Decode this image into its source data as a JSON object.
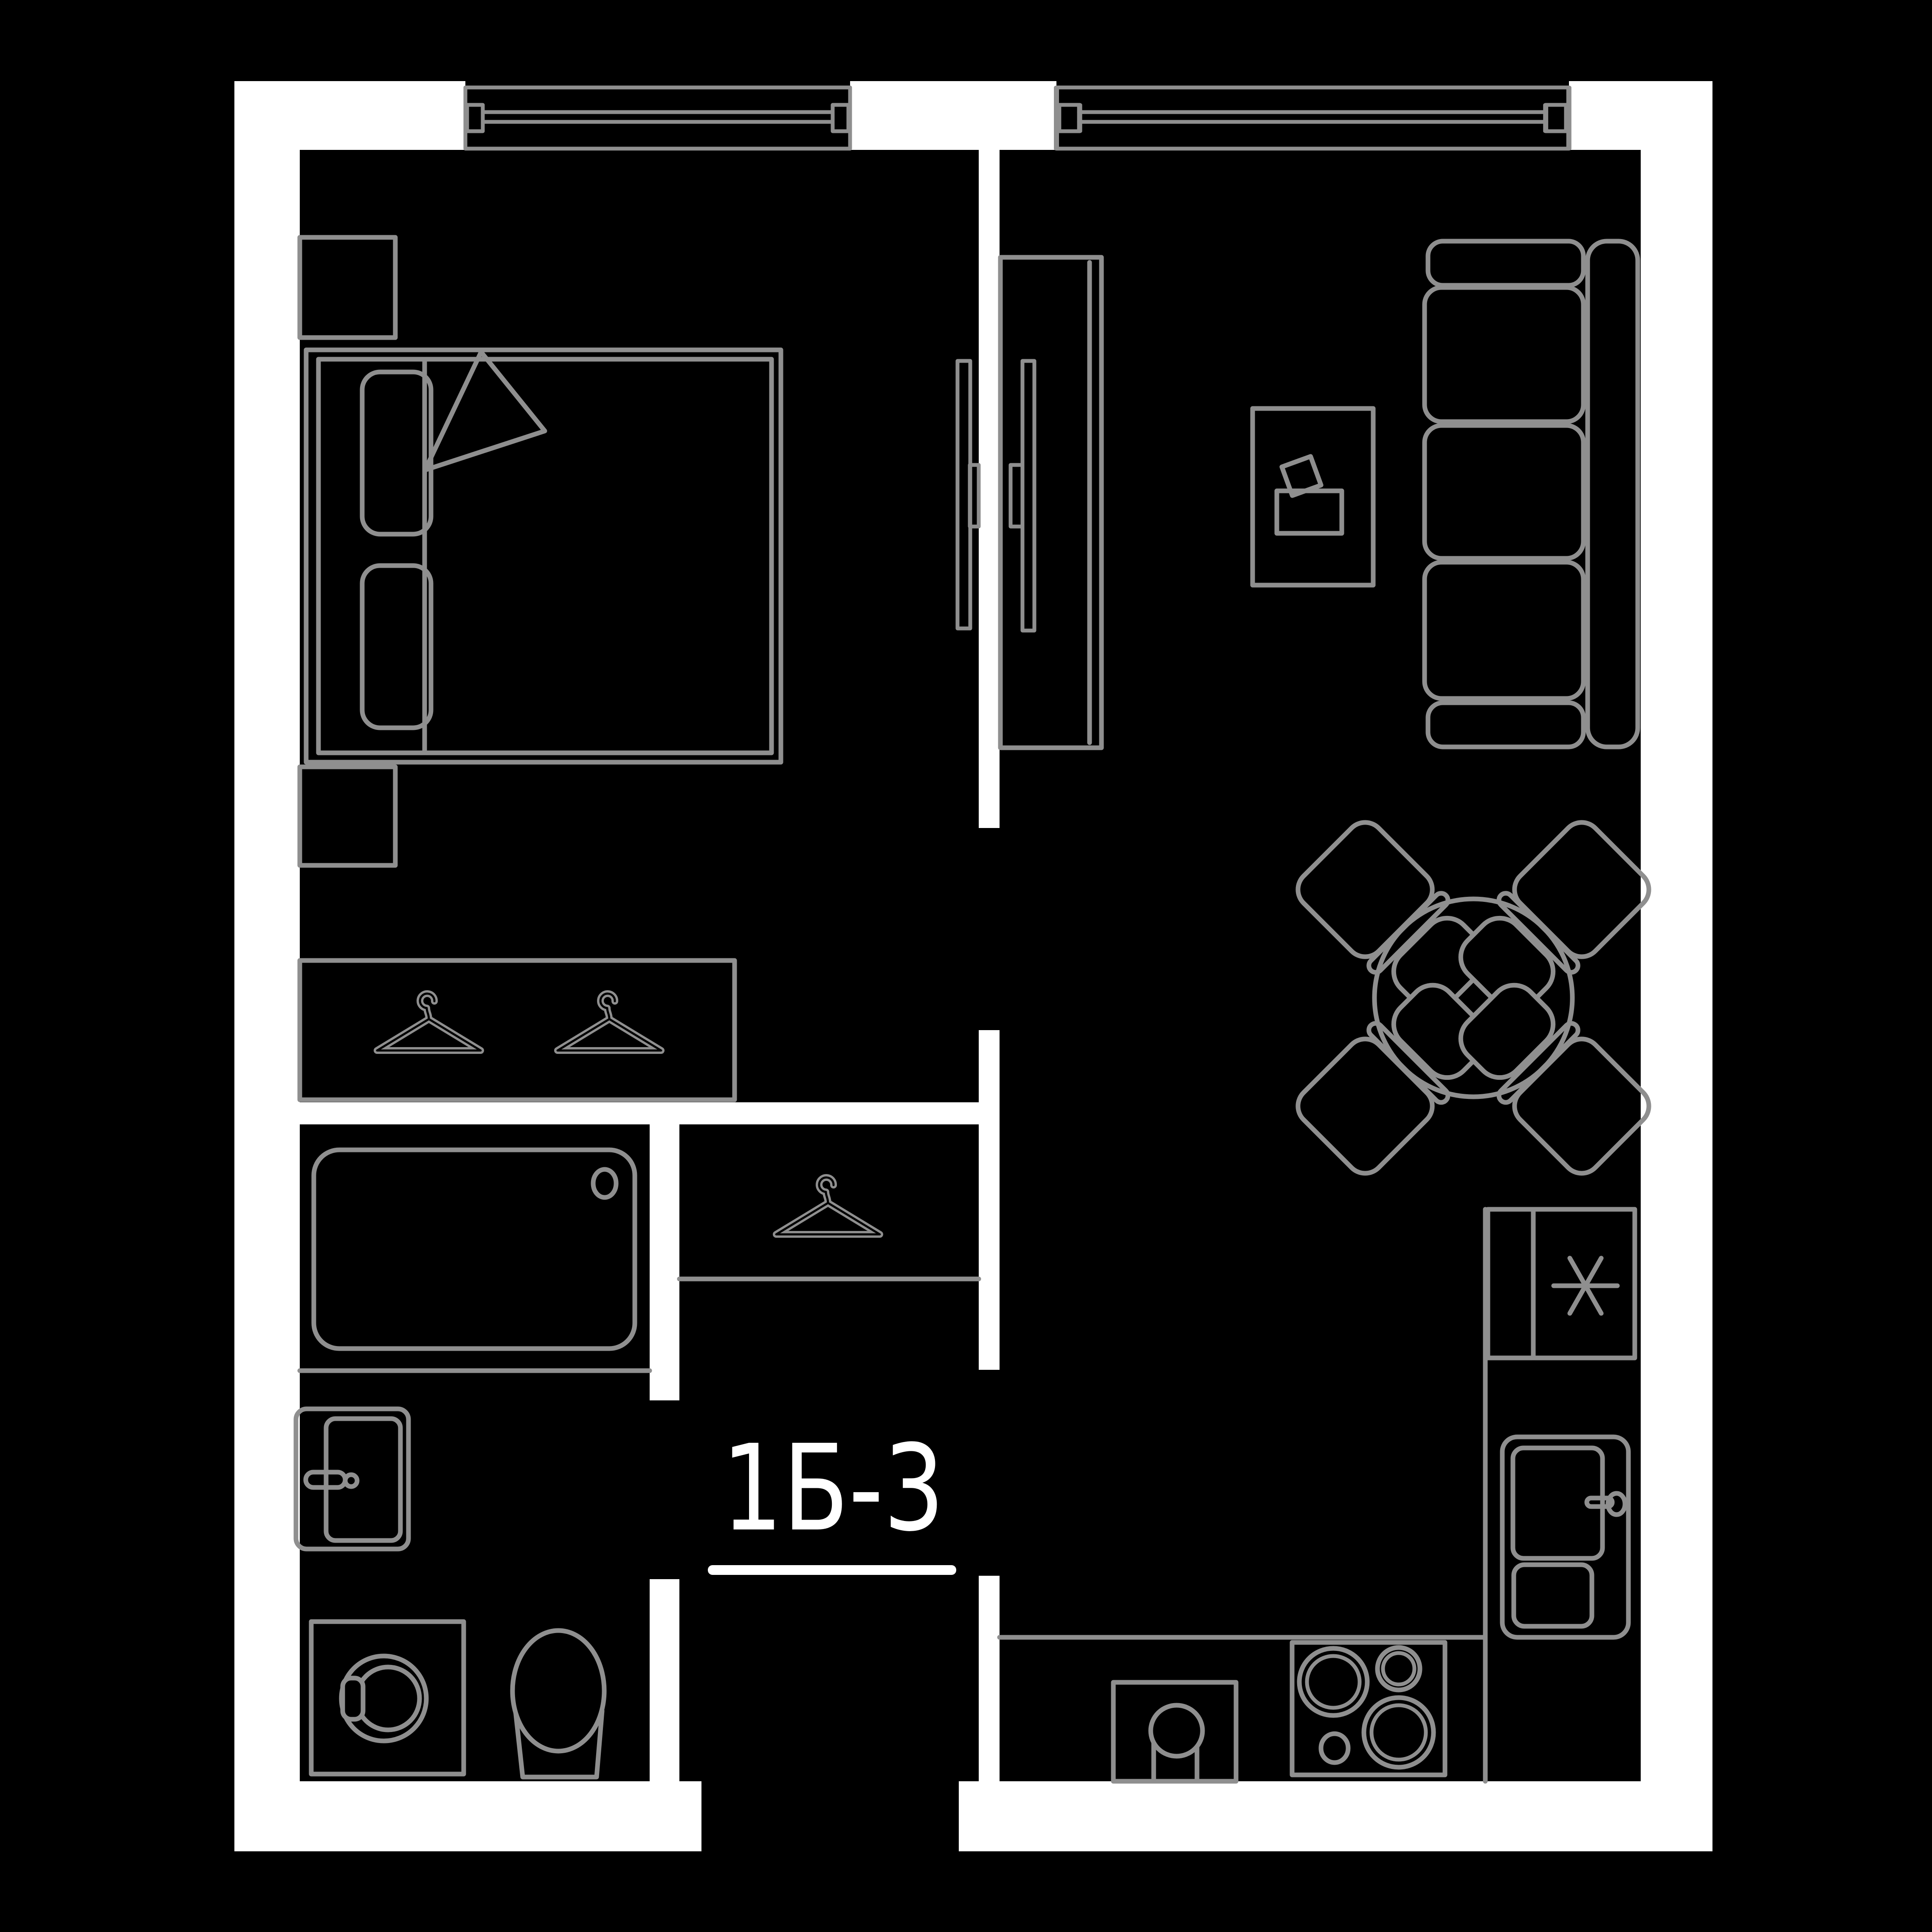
{
  "label": {
    "text": "1Б-3"
  },
  "colors": {
    "background": "#000000",
    "walls": "#ffffff",
    "furniture_lines": "#8f8f8f",
    "label_text": "#ffffff"
  }
}
